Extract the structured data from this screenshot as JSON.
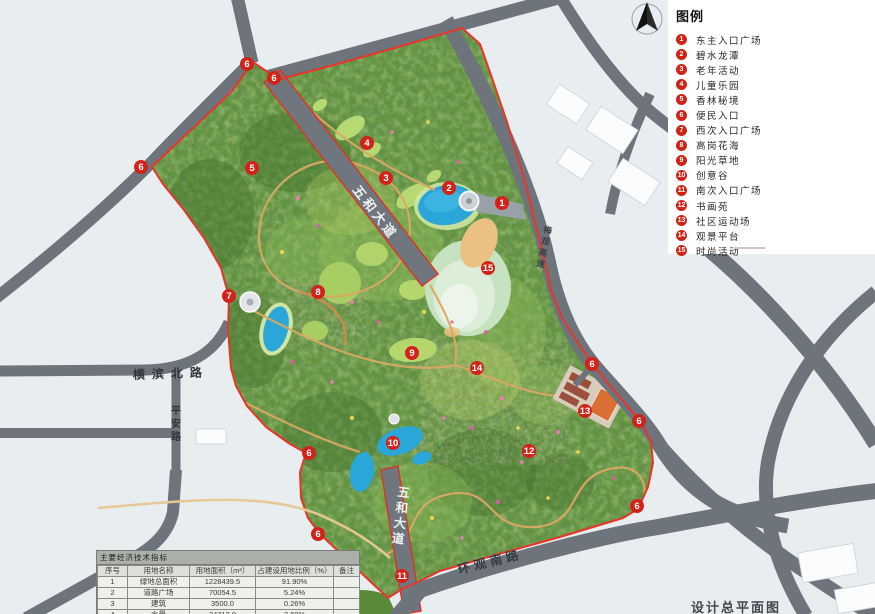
{
  "legend": {
    "title": "图例",
    "items": [
      {
        "num": "1",
        "label": "东主入口广场"
      },
      {
        "num": "2",
        "label": "碧水龙潭"
      },
      {
        "num": "3",
        "label": "老年活动"
      },
      {
        "num": "4",
        "label": "儿童乐园"
      },
      {
        "num": "5",
        "label": "香林秘境"
      },
      {
        "num": "6",
        "label": "便民入口"
      },
      {
        "num": "7",
        "label": "西次入口广场"
      },
      {
        "num": "8",
        "label": "高岗花海"
      },
      {
        "num": "9",
        "label": "阳光草地"
      },
      {
        "num": "10",
        "label": "创意谷"
      },
      {
        "num": "11",
        "label": "南次入口广场"
      },
      {
        "num": "12",
        "label": "书画苑"
      },
      {
        "num": "13",
        "label": "社区运动场"
      },
      {
        "num": "14",
        "label": "观景平台"
      },
      {
        "num": "15",
        "label": "时尚活动"
      }
    ]
  },
  "map": {
    "markers": [
      {
        "n": "6",
        "x": 247,
        "y": 64
      },
      {
        "n": "6",
        "x": 274,
        "y": 78
      },
      {
        "n": "6",
        "x": 141,
        "y": 167
      },
      {
        "n": "5",
        "x": 252,
        "y": 168
      },
      {
        "n": "4",
        "x": 367,
        "y": 143
      },
      {
        "n": "3",
        "x": 386,
        "y": 178
      },
      {
        "n": "2",
        "x": 449,
        "y": 188
      },
      {
        "n": "1",
        "x": 502,
        "y": 203
      },
      {
        "n": "15",
        "x": 488,
        "y": 268
      },
      {
        "n": "7",
        "x": 229,
        "y": 296
      },
      {
        "n": "8",
        "x": 318,
        "y": 292
      },
      {
        "n": "9",
        "x": 412,
        "y": 353
      },
      {
        "n": "14",
        "x": 477,
        "y": 368
      },
      {
        "n": "6",
        "x": 592,
        "y": 364
      },
      {
        "n": "13",
        "x": 585,
        "y": 411
      },
      {
        "n": "6",
        "x": 639,
        "y": 421
      },
      {
        "n": "10",
        "x": 393,
        "y": 443
      },
      {
        "n": "12",
        "x": 529,
        "y": 451
      },
      {
        "n": "6",
        "x": 309,
        "y": 453
      },
      {
        "n": "6",
        "x": 637,
        "y": 506
      },
      {
        "n": "6",
        "x": 318,
        "y": 534
      },
      {
        "n": "11",
        "x": 402,
        "y": 576
      }
    ],
    "road_labels": [
      {
        "text": "五和大道",
        "x": 352,
        "y": 190,
        "rotate": 52,
        "size": 13,
        "spacing": 3,
        "color": "#eef1f2",
        "vertical": false
      },
      {
        "text": "五和大道",
        "x": 397,
        "y": 496,
        "rotate": 7,
        "size": 12.5,
        "spacing": 3,
        "color": "#eef1f2",
        "vertical": true
      },
      {
        "text": "横滨北路",
        "x": 133,
        "y": 379,
        "rotate": -2,
        "size": 12,
        "spacing": 7,
        "color": "#2f353b",
        "vertical": false
      },
      {
        "text": "平安路",
        "x": 171,
        "y": 414,
        "rotate": 0,
        "size": 10,
        "spacing": 2,
        "color": "#2f353b",
        "vertical": true
      },
      {
        "text": "环观南路",
        "x": 459,
        "y": 574,
        "rotate": -14,
        "size": 12.5,
        "spacing": 4,
        "color": "#353b41",
        "vertical": false
      },
      {
        "text": "梅观高速",
        "x": 543,
        "y": 232,
        "rotate": 12,
        "size": 8.5,
        "spacing": 1,
        "color": "#3a4046",
        "vertical": true
      }
    ]
  },
  "table": {
    "title": "主要经济技术指标",
    "headers": [
      "序号",
      "用地名称",
      "用地面积（m²）",
      "占建设用地比例（%）",
      "备注"
    ],
    "rows": [
      [
        "1",
        "绿地总面积",
        "1228439.5",
        "91.90%",
        ""
      ],
      [
        "2",
        "道路广场",
        "70054.5",
        "5.24%",
        ""
      ],
      [
        "3",
        "建筑",
        "3500.0",
        "0.26%",
        ""
      ],
      [
        "4",
        "水景",
        "34712.0",
        "2.60%",
        ""
      ],
      [
        "",
        "合计",
        "1336706",
        "100",
        ""
      ]
    ]
  },
  "caption": "设计总平面图",
  "colors": {
    "background": "#e8edef",
    "road_gray": "#6e747b",
    "park_green": "#61903f",
    "boundary_red": "#e8352a",
    "marker_red": "#d2231a",
    "water_blue": "#2ba6d8"
  }
}
